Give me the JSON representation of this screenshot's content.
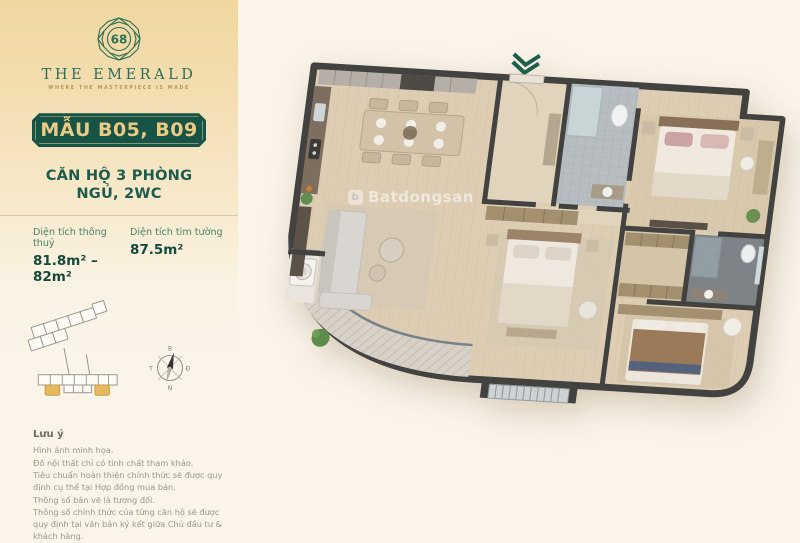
{
  "brand": {
    "logo_number": "68",
    "name": "THE EMERALD",
    "tagline": "WHERE THE MASTERPIECE IS MADE"
  },
  "unit": {
    "badge": "MẪU B05, B09",
    "type": "CĂN HỘ 3 PHÒNG NGỦ, 2WC",
    "areas": [
      {
        "label": "Diện tích thông thuỷ",
        "value": "81.8m² – 82m²"
      },
      {
        "label": "Diện tích tim tường",
        "value": "87.5m²"
      }
    ]
  },
  "compass": {
    "north": "B",
    "east": "Đ",
    "south": "N",
    "west": "T"
  },
  "notes": {
    "title": "Lưu ý",
    "items": [
      "Hình ảnh minh họa.",
      "Đồ nội thất chỉ có tính chất tham khảo.",
      "Tiêu chuẩn hoàn thiện chính thức sẽ được quy định cụ thể tại Hợp đồng mua bán.",
      "Thông số bản vẽ là tương đối.",
      "Thông số chính thức của từng căn hộ sẽ được quy định tại văn bản ký kết giữa Chủ đầu tư & khách hàng."
    ]
  },
  "watermark": {
    "logo_letter": "b",
    "text": "Batdongsan"
  },
  "colors": {
    "accent_green": "#1d5c4a",
    "badge_green": "#175446",
    "gold_text": "#ecca85",
    "panel_gold": "#f0d7a0",
    "wall": "#424240",
    "highlight_unit_gold": "#e5b95e"
  }
}
